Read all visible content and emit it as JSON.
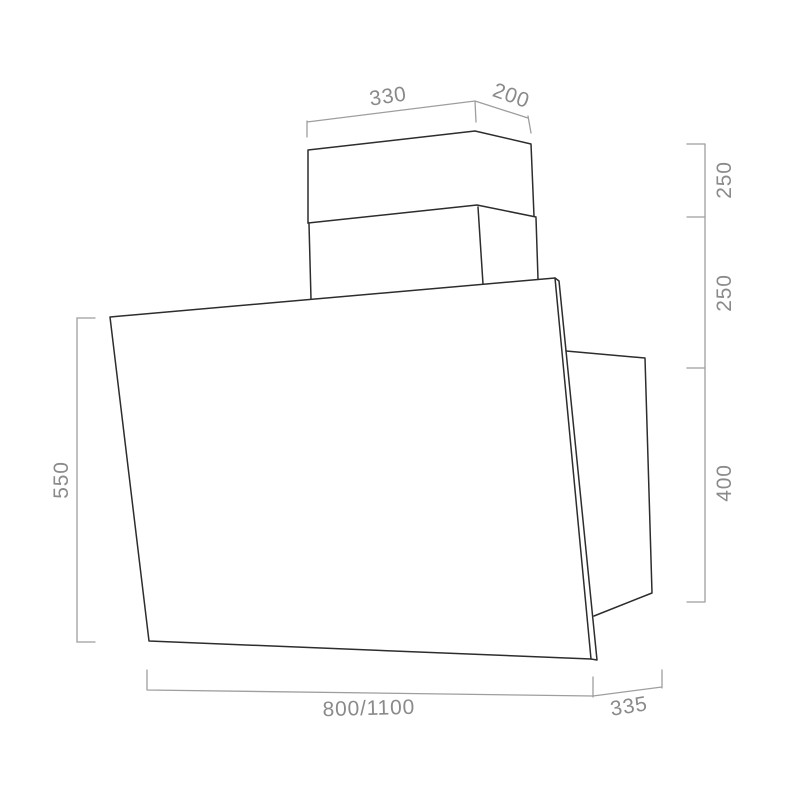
{
  "diagram": {
    "labels": {
      "chimney_width": "330",
      "chimney_depth": "200",
      "upper_chimney_height": "250",
      "lower_chimney_height": "250",
      "rear_box_height": "400",
      "panel_height": "550",
      "hood_width": "800/1100",
      "hood_depth": "335"
    },
    "colors": {
      "outline": "#2d2d2d",
      "dimension": "#9e9e9e",
      "label": "#8a8a8a",
      "background": "#ffffff"
    }
  }
}
